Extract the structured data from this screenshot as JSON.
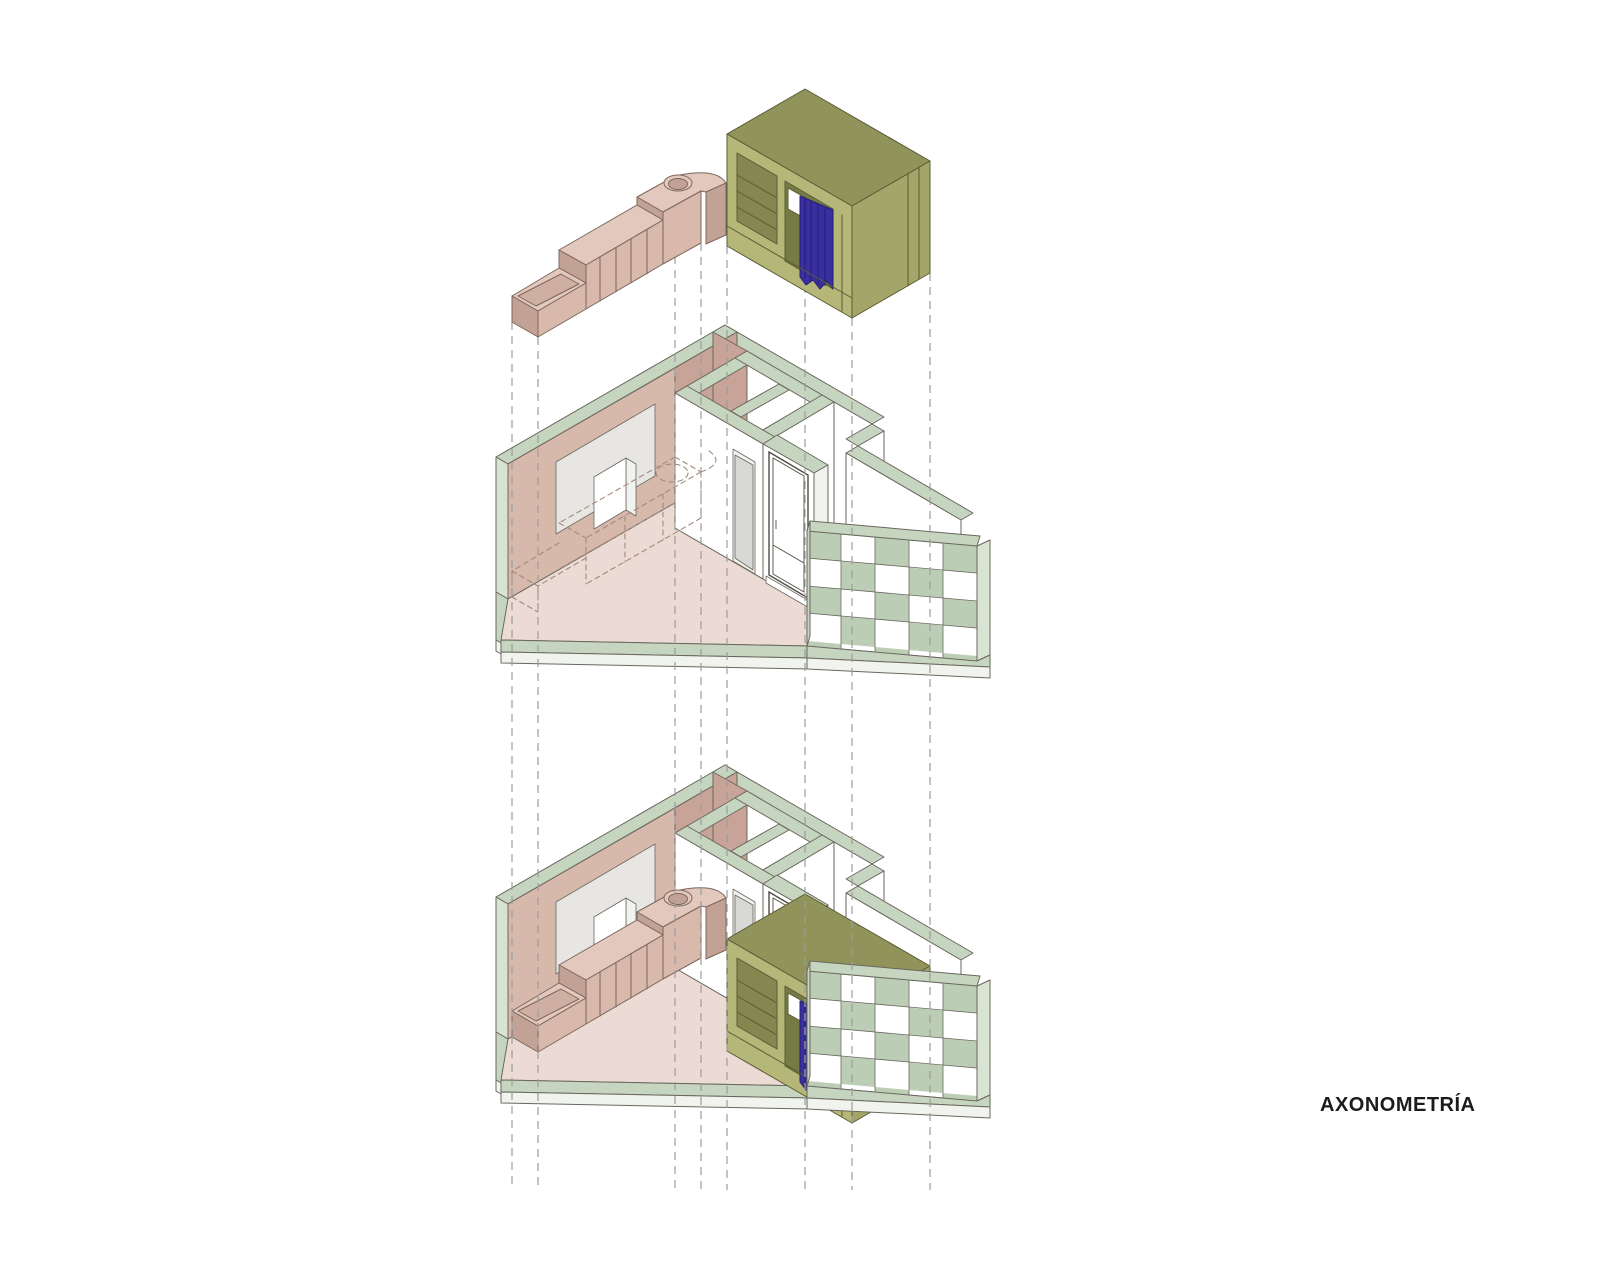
{
  "title": {
    "label": "AXONOMETRÍA"
  },
  "diagram": {
    "type": "exploded-axonometric",
    "levels": [
      "furniture-pieces",
      "room-shell",
      "assembled-room"
    ]
  },
  "colors": {
    "band": "#c6d5bf",
    "bandlt": "#d8e3d1",
    "white": "#ffffff",
    "shade": "#f1f3ee",
    "floor": "#ecdbd4",
    "pinklt": "#d7b9ac",
    "pinkdk": "#c7a497",
    "gray": "#e7e6e3",
    "cabtop": "#e3c9bd",
    "cabfront": "#d8b9ab",
    "cabside": "#c2a294",
    "trough": "#cfafa2",
    "olive": "#b4b778",
    "olivemid": "#a3a668",
    "olivedk": "#90935a",
    "oliveint": "#84874f",
    "olivedeep": "#767a45",
    "curtain": "#39309f",
    "curtainfold": "#251c7a",
    "checker": "#bccdb6",
    "outline": "#6b675f",
    "furnline": "#7d675c",
    "oliveline": "#5a5c35",
    "dashgray": "#9d9d9b",
    "ghostln": "#a2897d",
    "door": "#d8d8d6",
    "frameln": "#4f4c46",
    "textc": "#1c1c1c"
  }
}
